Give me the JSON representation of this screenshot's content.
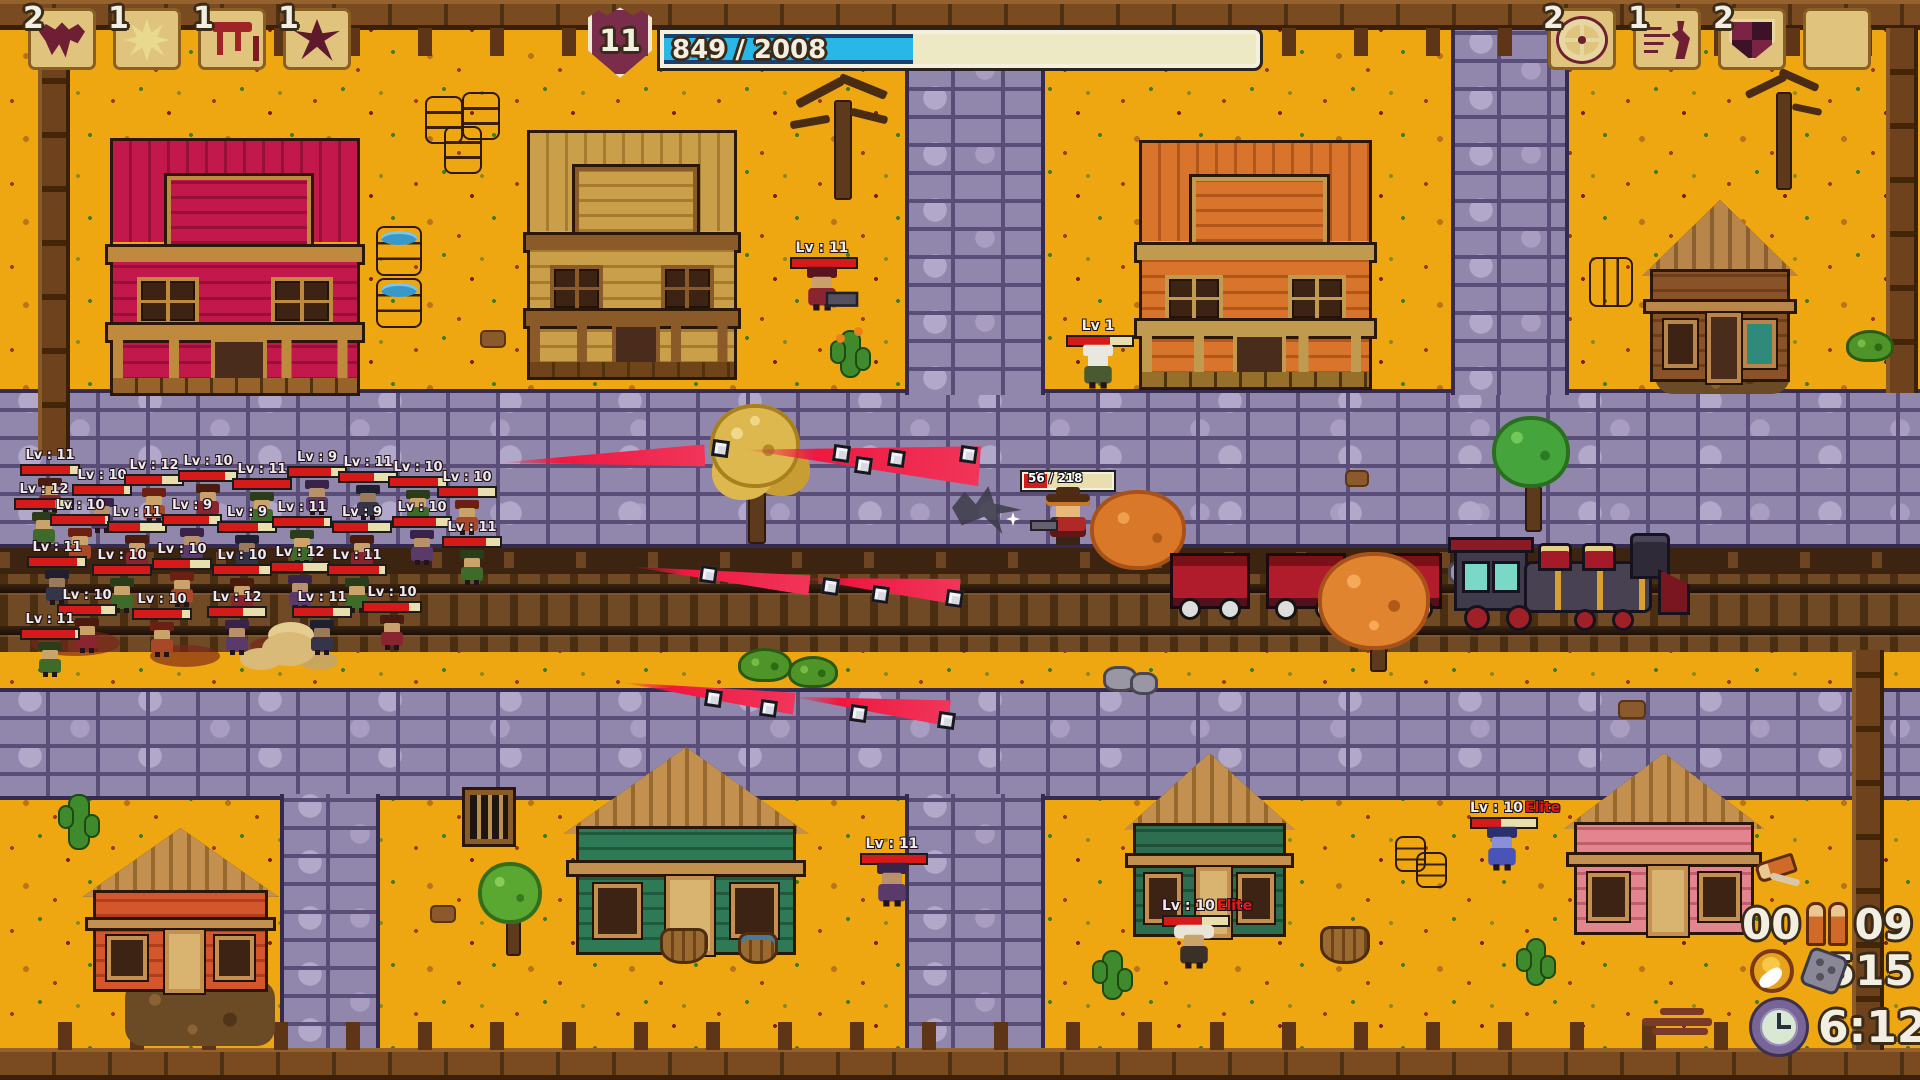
{
  "hud": {
    "level": "11",
    "xp_bar": {
      "label": "849 / 2008",
      "current": 849,
      "max": 2008,
      "fill_pct": 42
    },
    "weapon_slots": [
      {
        "count": "2",
        "icon": "bat-icon"
      },
      {
        "count": "1",
        "icon": "starburst-icon"
      },
      {
        "count": "1",
        "icon": "meat-icon"
      },
      {
        "count": "1",
        "icon": "raven-icon"
      }
    ],
    "item_slots": [
      {
        "count": "2",
        "icon": "wheel-icon"
      },
      {
        "count": "1",
        "icon": "runner-icon"
      },
      {
        "count": "2",
        "icon": "shield-icon"
      },
      {
        "count": "",
        "icon": "empty"
      }
    ],
    "ammo": {
      "loaded": "00",
      "reserve": "09"
    },
    "coins": "515",
    "timer": "6:12"
  },
  "player": {
    "x": 1020,
    "y": 472,
    "hp_label": "56 / 218",
    "hp_current": 56,
    "hp_max": 218,
    "hp_pct": 26
  },
  "named_enemies": [
    {
      "x": 790,
      "y": 240,
      "label": "Lv : 11",
      "elite": "",
      "hp": 100,
      "variant": "vgatling"
    },
    {
      "x": 1066,
      "y": 318,
      "label": "Lv 1",
      "elite": "",
      "hp": 65,
      "variant": "vskull"
    },
    {
      "x": 860,
      "y": 836,
      "label": "Lv : 11",
      "elite": "",
      "hp": 100,
      "variant": "v2"
    },
    {
      "x": 1470,
      "y": 800,
      "label": "Lv : 10",
      "elite": "Elite",
      "hp": 45,
      "variant": "vblue"
    },
    {
      "x": 1162,
      "y": 898,
      "label": "Lv : 10",
      "elite": "Elite",
      "hp": 60,
      "variant": "vboss"
    }
  ],
  "horde": [
    {
      "x": 18,
      "y": 448,
      "label": "Lv : 11",
      "hp": 85,
      "variant": "v0"
    },
    {
      "x": 12,
      "y": 482,
      "label": "Lv : 12",
      "hp": 70,
      "variant": "v1"
    },
    {
      "x": 70,
      "y": 468,
      "label": "Lv : 10",
      "hp": 90,
      "variant": "v2"
    },
    {
      "x": 122,
      "y": 458,
      "label": "Lv : 12",
      "hp": 65,
      "variant": "v3"
    },
    {
      "x": 176,
      "y": 454,
      "label": "Lv : 10",
      "hp": 80,
      "variant": "v0"
    },
    {
      "x": 230,
      "y": 462,
      "label": "Lv : 11",
      "hp": 100,
      "variant": "v1"
    },
    {
      "x": 285,
      "y": 450,
      "label": "Lv : 9",
      "hp": 75,
      "variant": "v2"
    },
    {
      "x": 336,
      "y": 455,
      "label": "Lv : 11",
      "hp": 60,
      "variant": "v4"
    },
    {
      "x": 386,
      "y": 460,
      "label": "Lv : 10",
      "hp": 85,
      "variant": "v1"
    },
    {
      "x": 48,
      "y": 498,
      "label": "Lv : 10",
      "hp": 95,
      "variant": "v3"
    },
    {
      "x": 105,
      "y": 505,
      "label": "Lv : 11",
      "hp": 55,
      "variant": "v0"
    },
    {
      "x": 160,
      "y": 498,
      "label": "Lv : 9",
      "hp": 80,
      "variant": "v2"
    },
    {
      "x": 215,
      "y": 505,
      "label": "Lv : 9",
      "hp": 70,
      "variant": "v4"
    },
    {
      "x": 270,
      "y": 500,
      "label": "Lv : 11",
      "hp": 90,
      "variant": "v1"
    },
    {
      "x": 330,
      "y": 505,
      "label": "Lv : 9",
      "hp": 60,
      "variant": "v0"
    },
    {
      "x": 390,
      "y": 500,
      "label": "Lv : 10",
      "hp": 75,
      "variant": "v2"
    },
    {
      "x": 25,
      "y": 540,
      "label": "Lv : 11",
      "hp": 85,
      "variant": "v4"
    },
    {
      "x": 90,
      "y": 548,
      "label": "Lv : 10",
      "hp": 100,
      "variant": "v1"
    },
    {
      "x": 150,
      "y": 542,
      "label": "Lv : 10",
      "hp": 65,
      "variant": "v3"
    },
    {
      "x": 210,
      "y": 548,
      "label": "Lv : 10",
      "hp": 80,
      "variant": "v0"
    },
    {
      "x": 268,
      "y": 545,
      "label": "Lv : 12",
      "hp": 55,
      "variant": "v2"
    },
    {
      "x": 325,
      "y": 548,
      "label": "Lv : 11",
      "hp": 90,
      "variant": "v1"
    },
    {
      "x": 435,
      "y": 470,
      "label": "Lv : 10",
      "hp": 70,
      "variant": "v3"
    },
    {
      "x": 55,
      "y": 588,
      "label": "Lv : 10",
      "hp": 75,
      "variant": "v0"
    },
    {
      "x": 130,
      "y": 592,
      "label": "Lv : 10",
      "hp": 85,
      "variant": "v3"
    },
    {
      "x": 205,
      "y": 590,
      "label": "Lv : 12",
      "hp": 60,
      "variant": "v2"
    },
    {
      "x": 18,
      "y": 612,
      "label": "Lv : 11",
      "hp": 95,
      "variant": "v1"
    },
    {
      "x": 290,
      "y": 590,
      "label": "Lv : 11",
      "hp": 70,
      "variant": "v4"
    },
    {
      "x": 360,
      "y": 585,
      "label": "Lv : 10",
      "hp": 80,
      "variant": "v0"
    },
    {
      "x": 440,
      "y": 520,
      "label": "Lv : 11",
      "hp": 75,
      "variant": "v1"
    }
  ],
  "colors": {
    "ground": "#efa711",
    "road": "#9187ac",
    "rail_bed": "#6f4a24",
    "hp_fill": "#d61a1a",
    "hp_track": "#e9dfae",
    "xp_blue": "#29b7e8",
    "elite_red": "#e81818"
  }
}
